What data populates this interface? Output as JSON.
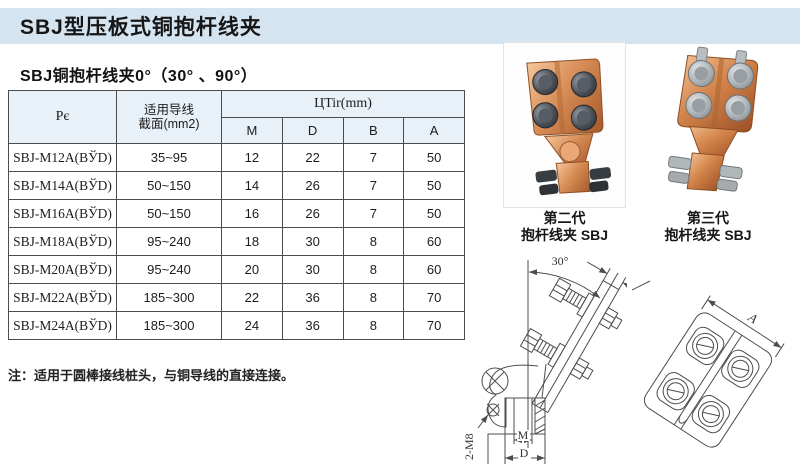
{
  "page": {
    "title": "SBJ型压板式铜抱杆线夹",
    "subtitle": "SBJ铜抱杆线夹0°（30° 、90°）",
    "note": "注：适用于圆棒接线桩头，与铜导线的直接连接。"
  },
  "table": {
    "headers": {
      "model": "Pє",
      "conductor_line1": "适用导线",
      "conductor_line2": "截面(mm2)",
      "dimensions_group": "ЦTir(mm)",
      "dimension_cols": [
        "M",
        "D",
        "B",
        "A"
      ]
    },
    "rows": [
      {
        "model": "SBJ-M12A(BЎD)",
        "section": "35~95",
        "M": "12",
        "D": "22",
        "B": "7",
        "A": "50"
      },
      {
        "model": "SBJ-M14A(BЎD)",
        "section": "50~150",
        "M": "14",
        "D": "26",
        "B": "7",
        "A": "50"
      },
      {
        "model": "SBJ-M16A(BЎD)",
        "section": "50~150",
        "M": "16",
        "D": "26",
        "B": "7",
        "A": "50"
      },
      {
        "model": "SBJ-M18A(BЎD)",
        "section": "95~240",
        "M": "18",
        "D": "30",
        "B": "8",
        "A": "60"
      },
      {
        "model": "SBJ-M20A(BЎD)",
        "section": "95~240",
        "M": "20",
        "D": "30",
        "B": "8",
        "A": "60"
      },
      {
        "model": "SBJ-M22A(BЎD)",
        "section": "185~300",
        "M": "22",
        "D": "36",
        "B": "8",
        "A": "70"
      },
      {
        "model": "SBJ-M24A(BЎD)",
        "section": "185~300",
        "M": "24",
        "D": "36",
        "B": "8",
        "A": "70"
      }
    ]
  },
  "photos": [
    {
      "caption_line1": "第二代",
      "caption_line2": "抱杆线夹 SBJ"
    },
    {
      "caption_line1": "第三代",
      "caption_line2": "抱杆线夹 SBJ"
    }
  ],
  "drawing": {
    "angle_label": "30°",
    "b_label": "B",
    "a_label": "A",
    "m_label": "M",
    "d_label": "D",
    "thread_label": "2-M8"
  },
  "colors": {
    "title_bar_bg": "#d5e4f1",
    "table_header_bg": "#e9f1f8",
    "table_border": "#4c4c4c",
    "copper_body": "#d98f58",
    "bolt_dark": "#3c4147",
    "bolt_silver": "#b9bec2"
  }
}
